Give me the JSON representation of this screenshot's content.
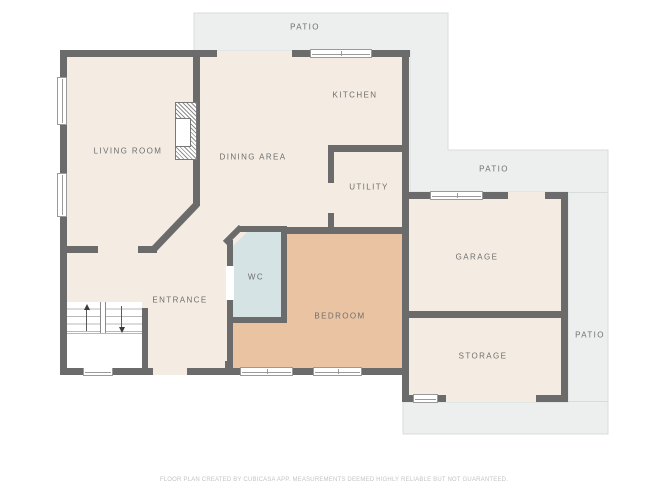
{
  "rooms": {
    "patio_top": {
      "label": "PATIO"
    },
    "patio_right_upper": {
      "label": "PATIO"
    },
    "patio_right_lower": {
      "label": "PATIO"
    },
    "living_room": {
      "label": "LIVING ROOM"
    },
    "dining_area": {
      "label": "DINING AREA"
    },
    "kitchen": {
      "label": "KITCHEN"
    },
    "utility": {
      "label": "UTILITY"
    },
    "wc": {
      "label": "WC"
    },
    "entrance": {
      "label": "ENTRANCE"
    },
    "bedroom": {
      "label": "BEDROOM"
    },
    "garage": {
      "label": "GARAGE"
    },
    "storage": {
      "label": "STORAGE"
    }
  },
  "footer": {
    "disclaimer": "FLOOR PLAN CREATED BY CUBICASA APP. MEASUREMENTS DEEMED HIGHLY RELIABLE BUT NOT GUARANTEED."
  },
  "colors": {
    "wall": "#6b6b6b",
    "floor": "#f4ece3",
    "bedroom": "#eac3a2",
    "wc": "#d6e3e5",
    "patio_fill": "#edefee",
    "patio_border": "#d8dcda",
    "winframe": "#9a9a9a",
    "labeltext": "#6e6e6e",
    "footertext": "#c4c4c4"
  }
}
